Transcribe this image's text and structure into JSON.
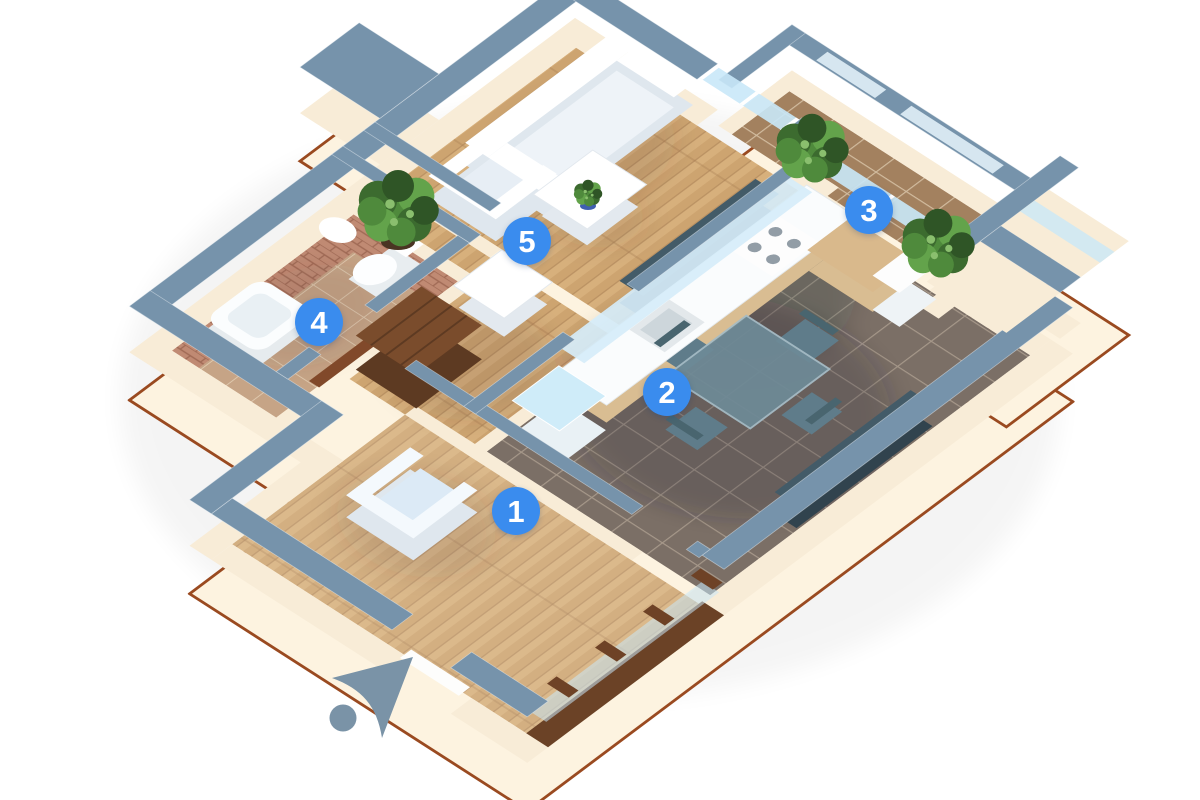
{
  "scene": {
    "type": "isometric-3d-apartment-floorplan-render",
    "background_color": "#ffffff"
  },
  "markers": [
    {
      "number": "1"
    },
    {
      "number": "2"
    },
    {
      "number": "3"
    },
    {
      "number": "4"
    },
    {
      "number": "5"
    }
  ],
  "compass": {
    "icon": "navigation-arrow-northeast"
  },
  "colors": {
    "marker_fill": "#3a8cee",
    "marker_text": "#ffffff",
    "wall_top": "#7693ab",
    "wall_face": "#f8ecd7",
    "wall_skirt": "#fdf3e0",
    "skirt_edge": "#9a4a20",
    "glass": "#c9e8f8",
    "floor_wood": "#cfa873",
    "floor_tile_dark": "#7b6f66",
    "floor_tile_balcony": "#a3815f",
    "floor_tile_bath": "#c6a486",
    "brick": "#c08a73",
    "wood_dark": "#7a4c2c",
    "plant_green": "#4f8a3c",
    "table_glass": "#6e8a97",
    "compass": "#7a93a7"
  }
}
